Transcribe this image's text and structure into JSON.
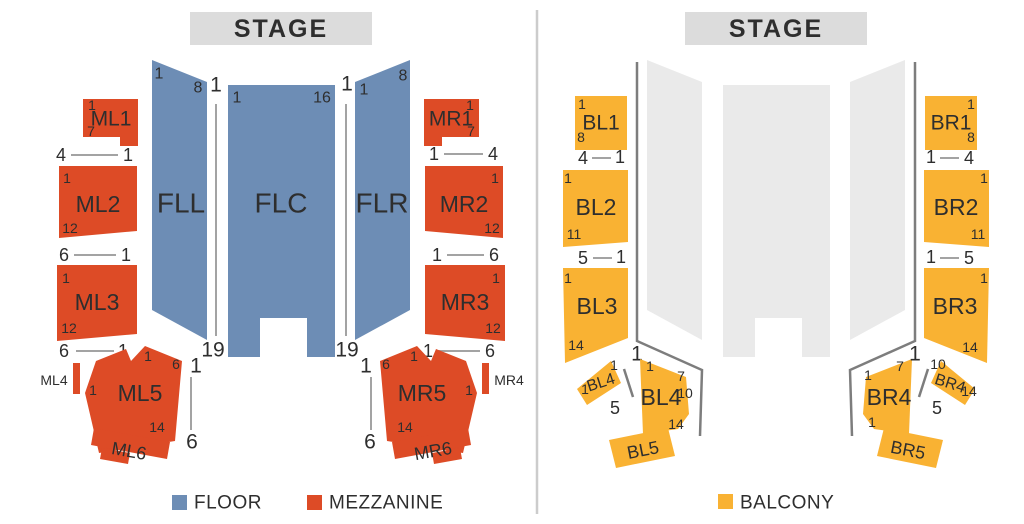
{
  "colors": {
    "floor": "#6d8db5",
    "mezzanine": "#dd4b26",
    "balcony": "#f9b233",
    "floor_muted": "#eaeaea",
    "stage": "#dcdcdc",
    "rail": "#7d7d7d",
    "aisle": "#a3a3a3",
    "divider": "#cccccc",
    "ink": "#2e2e2e"
  },
  "left": {
    "stage": "STAGE",
    "floor": {
      "FLL": {
        "label": "FLL",
        "n1": "1",
        "n2": "8"
      },
      "FLC": {
        "label": "FLC",
        "n1": "1",
        "n2": "16"
      },
      "FLR": {
        "label": "FLR",
        "n1": "1",
        "n2": "8"
      },
      "aisle_left": {
        "top": "1",
        "bottom": "19"
      },
      "aisle_right": {
        "top": "1",
        "bottom": "19"
      }
    },
    "mezz": {
      "ML1": {
        "label": "ML1",
        "n1": "1",
        "n2": "7"
      },
      "ML2": {
        "label": "ML2",
        "n1": "1",
        "n2": "12"
      },
      "ML3": {
        "label": "ML3",
        "n1": "1",
        "n2": "12"
      },
      "ML4": {
        "label": "ML4"
      },
      "ML5": {
        "label": "ML5",
        "top": "1",
        "topright": "6",
        "left": "1",
        "bottom": "14"
      },
      "ML6": {
        "label": "ML6"
      },
      "MR1": {
        "label": "MR1",
        "n1": "1",
        "n2": "7"
      },
      "MR2": {
        "label": "MR2",
        "n1": "1",
        "n2": "12"
      },
      "MR3": {
        "label": "MR3",
        "n1": "1",
        "n2": "12"
      },
      "MR4": {
        "label": "MR4"
      },
      "MR5": {
        "label": "MR5",
        "top": "1",
        "topleft": "6",
        "right": "1",
        "bottom": "14"
      },
      "MR6": {
        "label": "MR6"
      },
      "aisle_ml5": {
        "top": "1",
        "bottom": "6"
      },
      "aisle_mr5": {
        "top": "1",
        "bottom": "6"
      }
    },
    "rows": {
      "ml1": {
        "a": "4",
        "b": "1"
      },
      "ml2": {
        "a": "6",
        "b": "1"
      },
      "ml3": {
        "a": "6",
        "b": "1"
      },
      "mr1": {
        "a": "1",
        "b": "4"
      },
      "mr2": {
        "a": "1",
        "b": "6"
      },
      "mr3": {
        "a": "1",
        "b": "6"
      }
    },
    "legend": [
      {
        "label": "FLOOR"
      },
      {
        "label": "MEZZANINE"
      }
    ]
  },
  "right": {
    "stage": "STAGE",
    "balc": {
      "BL1": {
        "label": "BL1",
        "n1": "1",
        "n2": "8"
      },
      "BL2": {
        "label": "BL2",
        "n1": "1",
        "n2": "11"
      },
      "BL3": {
        "label": "BL3",
        "n1": "1",
        "n2": "14"
      },
      "BL4s": {
        "label": "BL4",
        "top": "1",
        "left": "1"
      },
      "BL4": {
        "label": "BL4",
        "tl": "1",
        "tr": "7",
        "r": "10",
        "br": "14"
      },
      "BL5": {
        "label": "BL5"
      },
      "BR1": {
        "label": "BR1",
        "n1": "1",
        "n2": "8"
      },
      "BR2": {
        "label": "BR2",
        "n1": "1",
        "n2": "11"
      },
      "BR3": {
        "label": "BR3",
        "n1": "1",
        "n2": "14"
      },
      "BR4": {
        "label": "BR4",
        "tl": "1",
        "tr": "7",
        "bl": "1"
      },
      "BR4s": {
        "label": "BR4",
        "top": "10",
        "right": "14"
      },
      "BR5": {
        "label": "BR5"
      },
      "aisle_bl": {
        "top": "1",
        "bottom": "5"
      },
      "aisle_br": {
        "top": "1",
        "bottom": "5"
      }
    },
    "rows": {
      "bl1": {
        "a": "4",
        "b": "1"
      },
      "bl2": {
        "a": "5",
        "b": "1"
      },
      "br1": {
        "a": "1",
        "b": "4"
      },
      "br2": {
        "a": "1",
        "b": "5"
      }
    },
    "legend": [
      {
        "label": "BALCONY"
      }
    ]
  }
}
